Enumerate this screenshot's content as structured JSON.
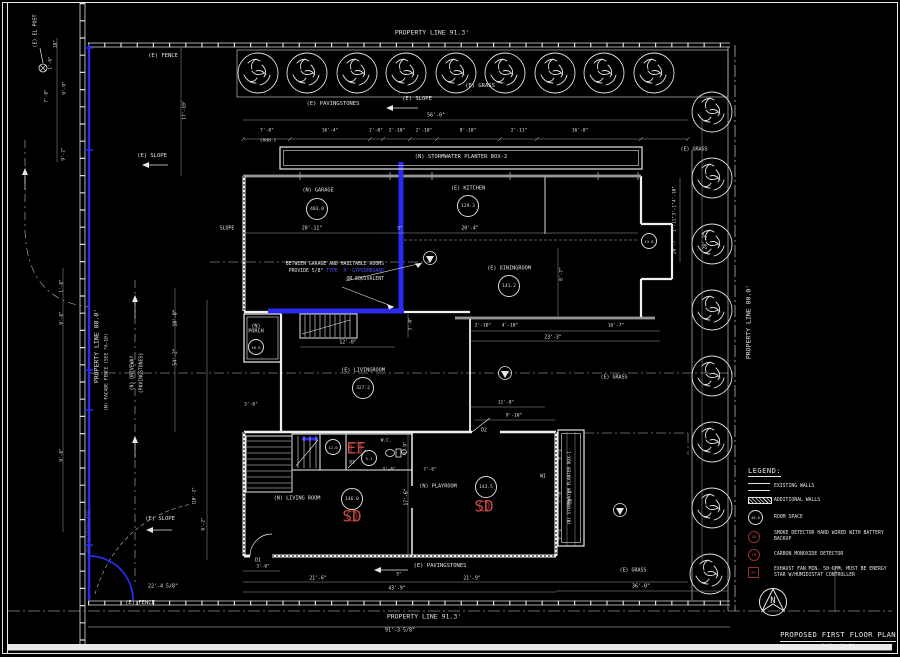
{
  "sheet": {
    "background": "#000000",
    "line_color": "#e2e2e2",
    "highlight_color": "#2a2af0",
    "detector_color": "#993030"
  },
  "title_block": {
    "title": "PROPOSED FIRST FLOOR PLAN",
    "scale": "1/4\" = 1'-0\"",
    "north_label": "N"
  },
  "note": {
    "line1": "BETWEEN GARAGE AND HABITABLE ROOMS",
    "line2_prefix": "PROVIDE 5/8\" ",
    "line2_highlight": "TYPE 'X' GYPSUMBOARD",
    "line3": "OR EQUIVALENT"
  },
  "legend": {
    "heading": "LEGEND:",
    "items": [
      {
        "id": "existing-walls",
        "tag": "",
        "label": "EXISTING WALLS"
      },
      {
        "id": "additional-walls",
        "tag": "",
        "label": "ADDITIONAL WALLS"
      },
      {
        "id": "room-space",
        "tag": "46.0",
        "label": "ROOM SPACE"
      },
      {
        "id": "smoke-detector",
        "tag": "SD",
        "label": "SMOKE DETECTOR HARD WIRED WITH BATTERY BACKUP"
      },
      {
        "id": "carbon-monoxide-detector",
        "tag": "CM",
        "label": "CARBON MONOXIDE DETECTOR"
      },
      {
        "id": "exhaust-fan",
        "tag": "EF",
        "label": "EXHAUST FAN MIN. 50 CFM, MUST BE ENERGY STAR W/HUMIDISTAT CONTROLLER"
      }
    ]
  },
  "rooms": [
    {
      "name": "garage",
      "label": "(N) GARAGE",
      "area": "403.0",
      "lx": 318,
      "ly": 191,
      "cx": 317,
      "cy": 209,
      "small": false
    },
    {
      "name": "kitchen",
      "label": "(E) KITCHEN",
      "area": "129.3",
      "lx": 468,
      "ly": 189,
      "cx": 468,
      "cy": 206,
      "small": false
    },
    {
      "name": "diningroom",
      "label": "(E) DININGROOM",
      "area": "141.2",
      "lx": 509,
      "ly": 269,
      "cx": 509,
      "cy": 286,
      "small": false
    },
    {
      "name": "livingroom-existing",
      "label": "(E) LIVINGROOM",
      "area": "327.2",
      "lx": 363,
      "ly": 371,
      "cx": 363,
      "cy": 388,
      "small": false
    },
    {
      "name": "porch",
      "label": "(N) PORCH",
      "area": "48.6",
      "lx": 256,
      "ly": 330,
      "cx": 256,
      "cy": 347,
      "small": true,
      "w": 26
    },
    {
      "name": "livingroom-new",
      "label": "(N) LIVING ROOM",
      "area": "146.0",
      "lx": 297,
      "ly": 499,
      "cx": 352,
      "cy": 499,
      "small": false
    },
    {
      "name": "playroom",
      "label": "(N) PLAYROOM",
      "area": "143.5",
      "lx": 438,
      "ly": 487,
      "cx": 486,
      "cy": 487,
      "small": false
    },
    {
      "name": "wc-room",
      "label": "",
      "area": "5.1",
      "lx": 0,
      "ly": 0,
      "cx": 369,
      "cy": 458,
      "small": true
    },
    {
      "name": "closet",
      "label": "",
      "area": "11.0",
      "lx": 0,
      "ly": 0,
      "cx": 333,
      "cy": 447,
      "small": true
    },
    {
      "name": "side-nook",
      "label": "",
      "area": "13.8",
      "lx": 0,
      "ly": 0,
      "cx": 649,
      "cy": 241,
      "small": true
    }
  ],
  "detectors": [
    {
      "t": "SD",
      "x": 352,
      "y": 516,
      "shape": "circle"
    },
    {
      "t": "SD",
      "x": 484,
      "y": 506,
      "shape": "circle"
    },
    {
      "t": "EF",
      "x": 356,
      "y": 448,
      "shape": "square"
    }
  ],
  "annotations": [
    {
      "name": "property-line-top-label",
      "text": "PROPERTY LINE 91.3'",
      "x": 432,
      "y": 33,
      "s": 6.5
    },
    {
      "name": "fence-top-label",
      "text": "(E) FENCE",
      "x": 163,
      "y": 57,
      "s": 5.5
    },
    {
      "name": "grass-top-label",
      "text": "(E) GRASS",
      "x": 480,
      "y": 87,
      "s": 5.5
    },
    {
      "name": "pavingstones-top-label",
      "text": "(E) PAVINGSTONES",
      "x": 333,
      "y": 105,
      "s": 5.5
    },
    {
      "name": "slope-top-label",
      "text": "(E) SLOPE",
      "x": 417,
      "y": 100,
      "s": 5.5
    },
    {
      "name": "dim-label",
      "text": "56'-0\"",
      "x": 436,
      "y": 116,
      "s": 5
    },
    {
      "name": "slope-upper-left-label",
      "text": "(E) SLOPE",
      "x": 152,
      "y": 157,
      "s": 5.5
    },
    {
      "name": "grass-upper-right-label",
      "text": "(E) GRASS",
      "x": 694,
      "y": 150,
      "s": 5
    },
    {
      "name": "planter-box-2-label",
      "text": "(N) STORMWATER PLANTER BOX-2",
      "x": 461,
      "y": 158,
      "s": 5.5
    },
    {
      "name": "el-post-label",
      "text": "(E) EL POST",
      "x": 36,
      "y": 31,
      "r": 1,
      "s": 5
    },
    {
      "name": "property-line-left-label",
      "text": "PROPERTY LINE 80.0'",
      "x": 97,
      "y": 346,
      "r": 1,
      "s": 6.5
    },
    {
      "name": "facade-fence-label",
      "text": "(N) FACADE FENCE (SEE *A-10)",
      "x": 108,
      "y": 372,
      "r": 1,
      "s": 4.6
    },
    {
      "name": "driveway-label-1",
      "text": "(N) DRIVEWAY",
      "x": 133,
      "y": 373,
      "r": 1,
      "s": 4.8
    },
    {
      "name": "driveway-label-2",
      "text": "(PAVINGSTONES)",
      "x": 142,
      "y": 373,
      "r": 1,
      "s": 4.8
    },
    {
      "name": "dim-label",
      "text": "18'-8\"",
      "x": 176,
      "y": 318,
      "r": 1,
      "s": 4.8
    },
    {
      "name": "dim-label",
      "text": "54'-2\"",
      "x": 176,
      "y": 357,
      "r": 1,
      "s": 4.8
    },
    {
      "name": "sliding-gate-label",
      "text": "(N) SLIDINGGATE",
      "x": 90,
      "y": 532,
      "r": 1,
      "s": 4.8,
      "c": "hl"
    },
    {
      "name": "slope-lower-left-label",
      "text": "(E) SLOPE",
      "x": 160,
      "y": 520,
      "s": 5.5
    },
    {
      "name": "dim-label",
      "text": "22'-4 5/8\"",
      "x": 163,
      "y": 587,
      "s": 5
    },
    {
      "name": "fence-bottom-label",
      "text": "(E) FENCE",
      "x": 140,
      "y": 604,
      "s": 5.5
    },
    {
      "name": "pavingstones-bottom-label",
      "text": "(E) PAVINGSTONES",
      "x": 440,
      "y": 567,
      "s": 5.5
    },
    {
      "name": "property-line-bottom-label",
      "text": "PROPERTY LINE 91.3'",
      "x": 424,
      "y": 617,
      "s": 6.5
    },
    {
      "name": "dim-label",
      "text": "91'-3 5/8\"",
      "x": 400,
      "y": 631,
      "s": 5
    },
    {
      "name": "grass-lower-right-label",
      "text": "(E) GRASS",
      "x": 633,
      "y": 571,
      "s": 5
    },
    {
      "name": "dim-label",
      "text": "36'-0\"",
      "x": 641,
      "y": 587,
      "s": 5
    },
    {
      "name": "grass-mid-right-label",
      "text": "(E) GRASS",
      "x": 614,
      "y": 378,
      "s": 5
    },
    {
      "name": "property-line-right-label",
      "text": "PROPERTY LINE 80.0'",
      "x": 749,
      "y": 322,
      "r": 1,
      "s": 6.5
    },
    {
      "name": "dim-label",
      "text": "28'-3\"",
      "x": 706,
      "y": 241,
      "r": 1,
      "s": 4.8
    },
    {
      "name": "planter-box-1-label",
      "text": "(N) STORMWATER PLANTER BOX-1",
      "x": 571,
      "y": 488,
      "r": 1,
      "s": 4.4
    },
    {
      "name": "slope-garage-label",
      "text": "SLOPE",
      "x": 227,
      "y": 229,
      "s": 4.8
    },
    {
      "name": "dim-label",
      "text": "17'-10\"",
      "x": 186,
      "y": 110,
      "r": 1,
      "s": 4.6
    },
    {
      "name": "dim-label",
      "text": "7'-8\"",
      "x": 267,
      "y": 132,
      "s": 4.6
    },
    {
      "name": "dim-label",
      "text": "(Add.)",
      "x": 268,
      "y": 142,
      "s": 4.6
    },
    {
      "name": "dim-label",
      "text": "16'-4\"",
      "x": 330,
      "y": 132,
      "s": 4.6
    },
    {
      "name": "dim-label",
      "text": "2'-0\"",
      "x": 376,
      "y": 132,
      "s": 4.6
    },
    {
      "name": "dim-label",
      "text": "2'-10\"",
      "x": 397,
      "y": 132,
      "s": 4.6
    },
    {
      "name": "dim-label",
      "text": "2'-10\"",
      "x": 424,
      "y": 132,
      "s": 4.6
    },
    {
      "name": "dim-label",
      "text": "8'-10\"",
      "x": 468,
      "y": 132,
      "s": 4.6
    },
    {
      "name": "dim-label",
      "text": "2'-11\"",
      "x": 519,
      "y": 132,
      "s": 4.6
    },
    {
      "name": "dim-label",
      "text": "16'-0\"",
      "x": 580,
      "y": 132,
      "s": 4.6
    },
    {
      "name": "dim-label",
      "text": "20'-11\"",
      "x": 312,
      "y": 229,
      "s": 4.8
    },
    {
      "name": "dim-label",
      "text": "5\"",
      "x": 400,
      "y": 230,
      "s": 4.4
    },
    {
      "name": "dim-label",
      "text": "20'-4\"",
      "x": 470,
      "y": 229,
      "s": 4.8
    },
    {
      "name": "dim-label",
      "text": "2'-10\"",
      "x": 483,
      "y": 327,
      "s": 4.6
    },
    {
      "name": "dim-label",
      "text": "4'-10\"",
      "x": 510,
      "y": 327,
      "s": 4.6
    },
    {
      "name": "dim-label",
      "text": "16'-7\"",
      "x": 616,
      "y": 327,
      "s": 4.6
    },
    {
      "name": "dim-label",
      "text": "23'-3\"",
      "x": 553,
      "y": 338,
      "s": 4.8
    },
    {
      "name": "dim-label",
      "text": "8'-7\"",
      "x": 563,
      "y": 274,
      "r": 1,
      "s": 4.6
    },
    {
      "name": "dim-label",
      "text": "12'-0\"",
      "x": 348,
      "y": 343,
      "s": 4.8
    },
    {
      "name": "dim-label",
      "text": "3'-0\"",
      "x": 412,
      "y": 324,
      "r": 1,
      "s": 4.4
    },
    {
      "name": "dim-label",
      "text": "11'-0\"",
      "x": 506,
      "y": 404,
      "s": 4.6
    },
    {
      "name": "dim-label",
      "text": "9'-10\"",
      "x": 514,
      "y": 417,
      "s": 4.6
    },
    {
      "name": "dim-label",
      "text": "3'-6\"",
      "x": 251,
      "y": 406,
      "s": 4.6
    },
    {
      "name": "dim-label",
      "text": "3'-6\"",
      "x": 389,
      "y": 471,
      "s": 4.4
    },
    {
      "name": "dim-label",
      "text": "7'-6\"",
      "x": 430,
      "y": 471,
      "s": 4.4
    },
    {
      "name": "dim-label",
      "text": "4'-9\"",
      "x": 407,
      "y": 448,
      "r": 1,
      "s": 4.4
    },
    {
      "name": "dim-label",
      "text": "17'-6\"",
      "x": 407,
      "y": 497,
      "r": 1,
      "s": 4.8
    },
    {
      "name": "dim-label",
      "text": "3'-0\"",
      "x": 263,
      "y": 568,
      "s": 4.4
    },
    {
      "name": "dim-label",
      "text": "21'-6\"",
      "x": 318,
      "y": 579,
      "s": 4.8
    },
    {
      "name": "dim-label",
      "text": "5\"",
      "x": 399,
      "y": 576,
      "s": 4.4
    },
    {
      "name": "dim-label",
      "text": "21'-9\"",
      "x": 472,
      "y": 579,
      "s": 4.8
    },
    {
      "name": "dim-label",
      "text": "43'-9\"",
      "x": 397,
      "y": 589,
      "s": 4.8
    },
    {
      "name": "dim-label",
      "text": "8'-2\"",
      "x": 561,
      "y": 453,
      "r": 1,
      "s": 4.4
    },
    {
      "name": "dim-label",
      "text": "7'-8\"",
      "x": 561,
      "y": 496,
      "r": 1,
      "s": 4.4
    },
    {
      "name": "dim-label",
      "text": "12'-2\"",
      "x": 572,
      "y": 496,
      "r": 1,
      "s": 4.4
    },
    {
      "name": "dim-label",
      "text": "6'-2\"",
      "x": 561,
      "y": 533,
      "r": 1,
      "s": 4.4
    },
    {
      "name": "dim-label",
      "text": "4'-10\"",
      "x": 676,
      "y": 194,
      "r": 1,
      "s": 4.4
    },
    {
      "name": "dim-label",
      "text": "3'-1\"",
      "x": 676,
      "y": 209,
      "r": 1,
      "s": 4.4
    },
    {
      "name": "dim-label",
      "text": "1'-11\"",
      "x": 676,
      "y": 224,
      "r": 1,
      "s": 4.4
    },
    {
      "name": "dim-label",
      "text": "20'-7\"",
      "x": 676,
      "y": 246,
      "r": 1,
      "s": 4.4
    },
    {
      "name": "dim-label",
      "text": "18\"",
      "x": 57,
      "y": 44,
      "r": 1,
      "s": 4.4
    },
    {
      "name": "dim-label",
      "text": "1'-6\"",
      "x": 52,
      "y": 63,
      "r": 1,
      "s": 4.4
    },
    {
      "name": "dim-label",
      "text": "9'-9\"",
      "x": 66,
      "y": 88,
      "r": 1,
      "s": 4.4
    },
    {
      "name": "dim-label",
      "text": "7'-8\"",
      "x": 48,
      "y": 96,
      "r": 1,
      "s": 4.4
    },
    {
      "name": "dim-label",
      "text": "9'-2\"",
      "x": 65,
      "y": 154,
      "r": 1,
      "s": 4.4
    },
    {
      "name": "dim-label",
      "text": "1'-8\"",
      "x": 63,
      "y": 286,
      "r": 1,
      "s": 4.4
    },
    {
      "name": "dim-label",
      "text": "9'-8\"",
      "x": 63,
      "y": 318,
      "r": 1,
      "s": 4.4
    },
    {
      "name": "dim-label",
      "text": "9'-8\"",
      "x": 63,
      "y": 455,
      "r": 1,
      "s": 4.4
    },
    {
      "name": "dim-label",
      "text": "10'-2\"",
      "x": 196,
      "y": 495,
      "r": 1,
      "s": 4.4
    },
    {
      "name": "dim-label",
      "text": "8'-2\"",
      "x": 205,
      "y": 524,
      "r": 1,
      "s": 4.4
    },
    {
      "name": "door-tag-d1",
      "text": "D1",
      "x": 258,
      "y": 561,
      "s": 4.8
    },
    {
      "name": "door-tag-d2",
      "text": "D2",
      "x": 484,
      "y": 431,
      "s": 4.8
    },
    {
      "name": "door-tag-d3",
      "text": "D3",
      "x": 352,
      "y": 464,
      "s": 4.4
    },
    {
      "name": "window-tag-w1",
      "text": "W1",
      "x": 543,
      "y": 477,
      "s": 4.8
    },
    {
      "name": "wc-label",
      "text": "W.C.",
      "x": 386,
      "y": 442,
      "s": 4.4
    }
  ]
}
